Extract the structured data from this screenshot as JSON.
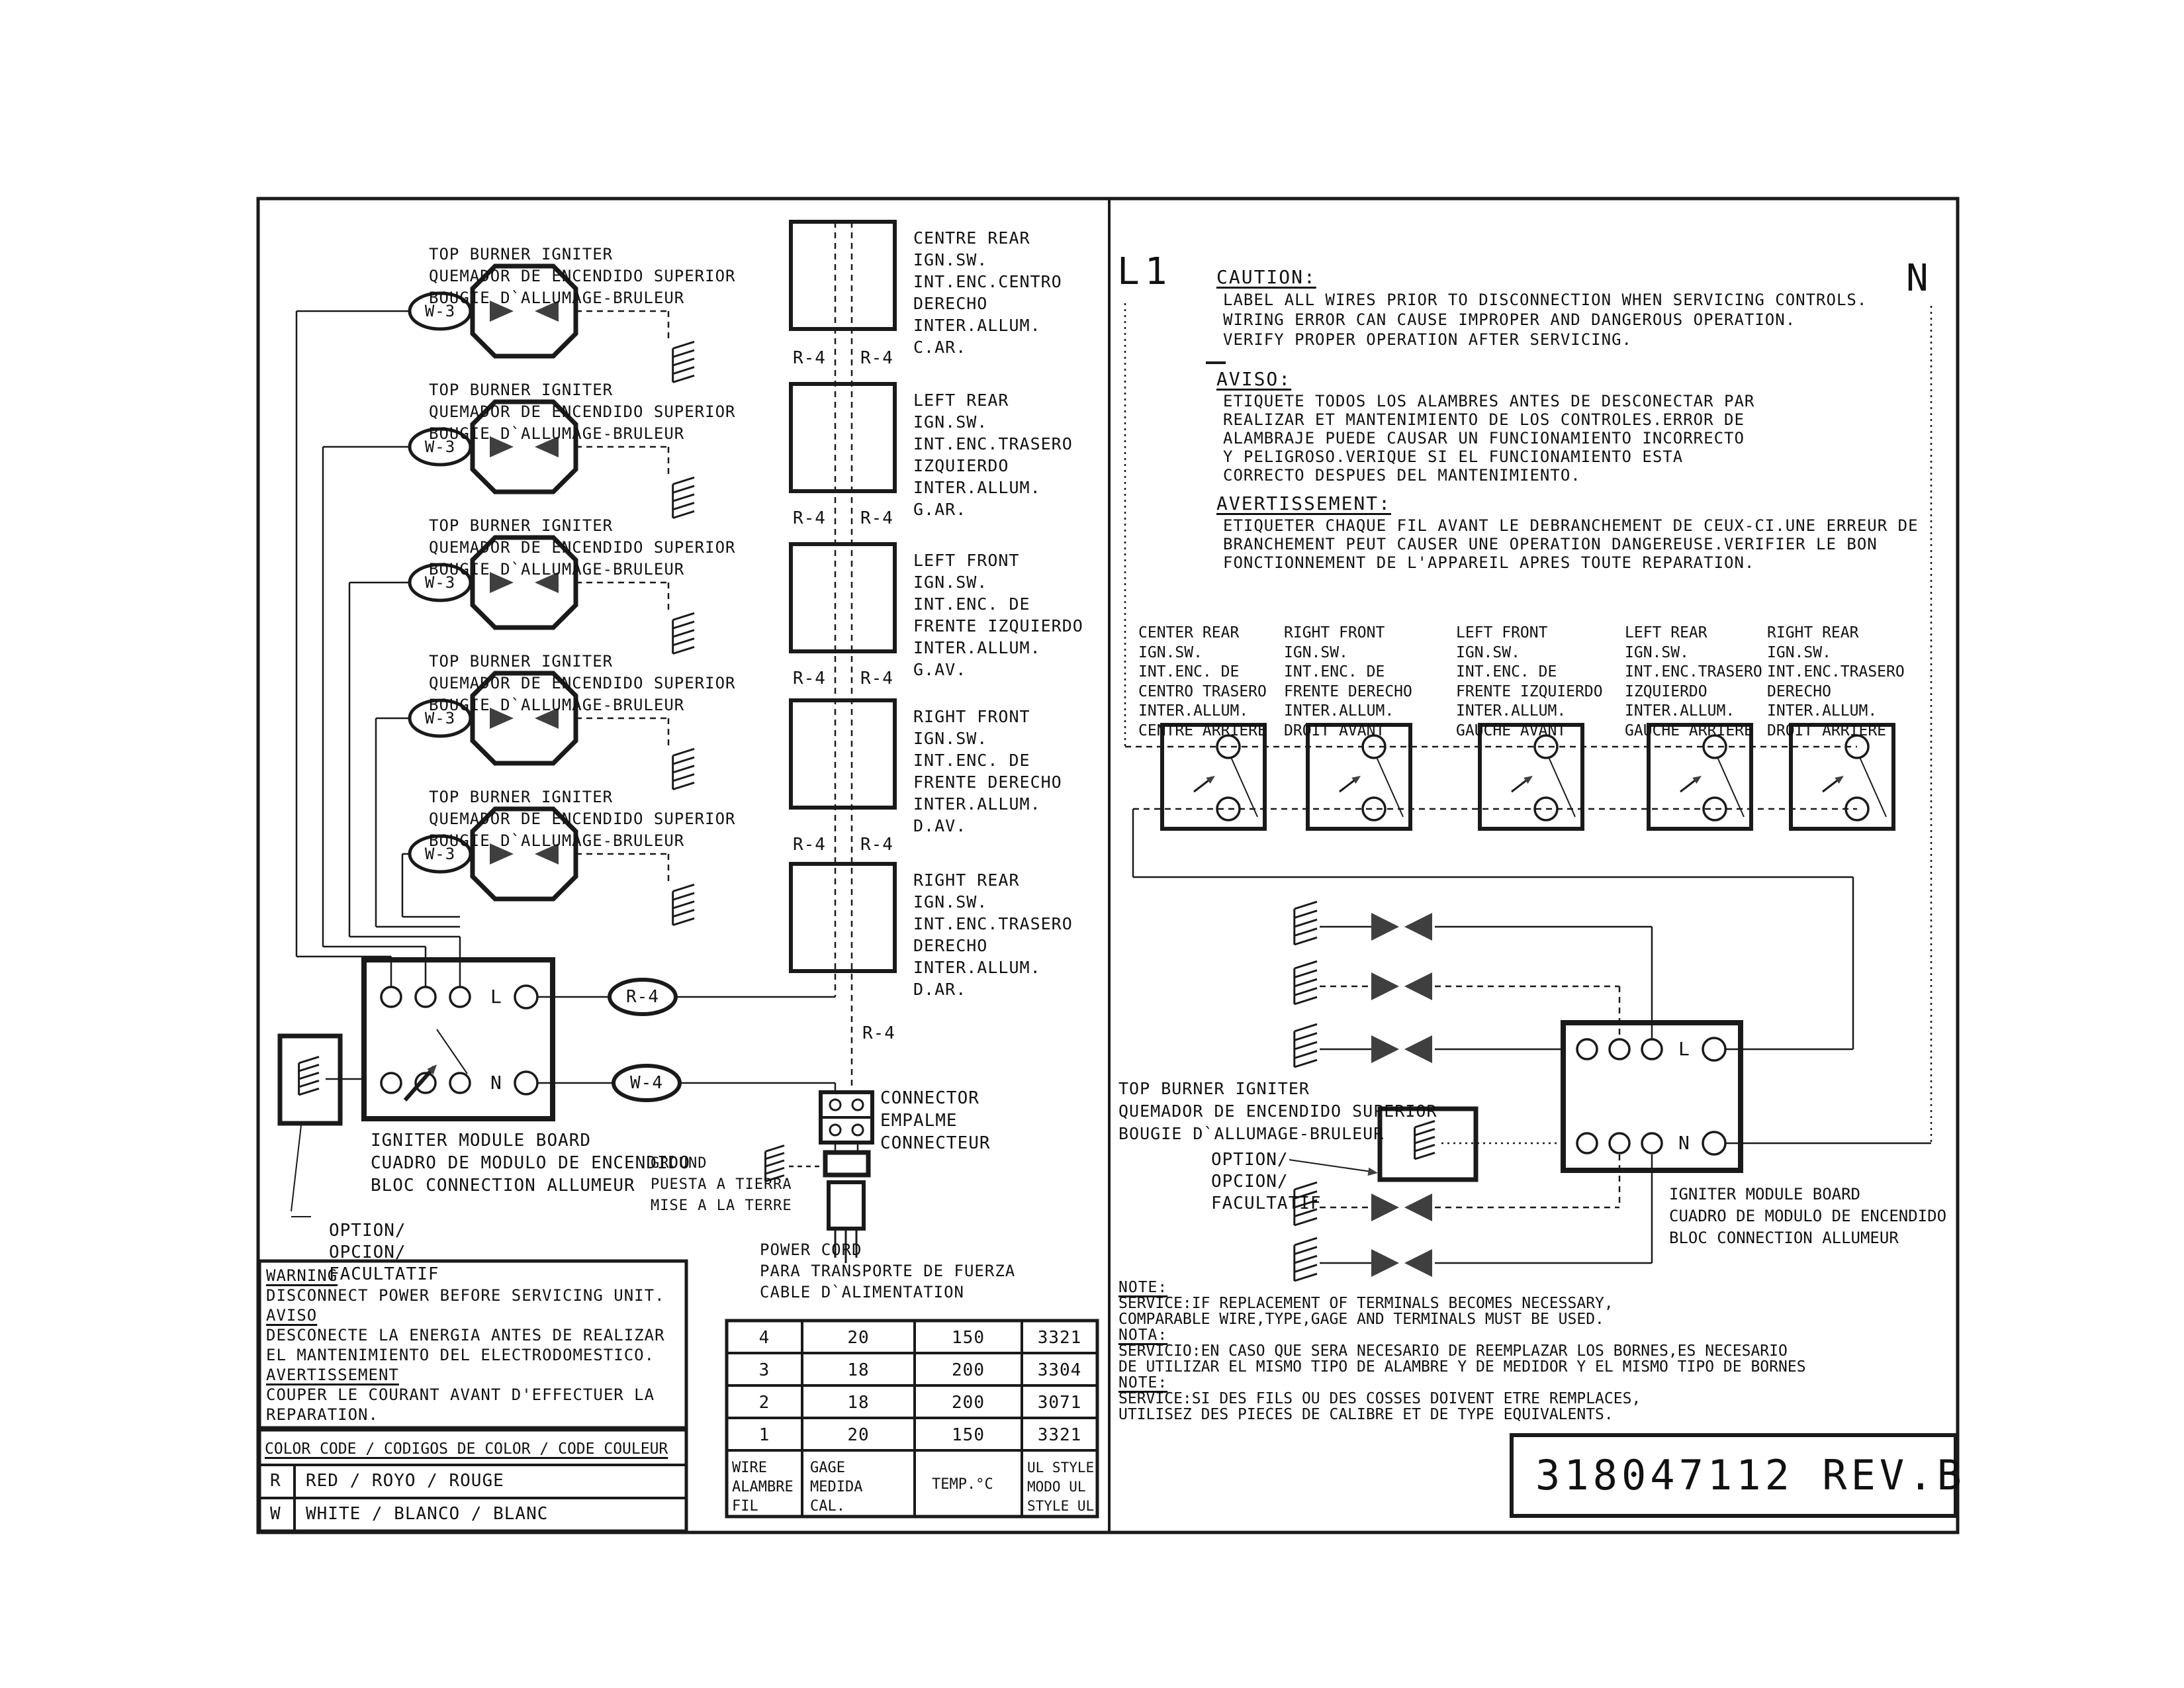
{
  "drawing": {
    "part_number": "318047112 REV.B",
    "l1": "L1",
    "n_supply": "N",
    "w3": "W-3",
    "r4": "R-4",
    "w4": "W-4",
    "terminal_l": "L",
    "terminal_n": "N"
  },
  "left": {
    "igniter_label": [
      "TOP BURNER IGNITER",
      "QUEMADOR DE ENCENDIDO SUPERIOR",
      "BOUGIE D`ALLUMAGE-BRULEUR"
    ],
    "switches": [
      {
        "lines": [
          "CENTRE REAR",
          "IGN.SW.",
          "INT.ENC.CENTRO",
          "DERECHO",
          "INTER.ALLUM.",
          "C.AR."
        ]
      },
      {
        "lines": [
          "LEFT REAR",
          "IGN.SW.",
          "INT.ENC.TRASERO",
          "IZQUIERDO",
          "INTER.ALLUM.",
          "G.AR."
        ]
      },
      {
        "lines": [
          "LEFT FRONT",
          "IGN.SW.",
          "INT.ENC. DE",
          "FRENTE IZQUIERDO",
          "INTER.ALLUM.",
          "G.AV."
        ]
      },
      {
        "lines": [
          "RIGHT FRONT",
          "IGN.SW.",
          "INT.ENC. DE",
          "FRENTE DERECHO",
          "INTER.ALLUM.",
          "D.AV."
        ]
      },
      {
        "lines": [
          "RIGHT REAR",
          "IGN.SW.",
          "INT.ENC.TRASERO",
          "DERECHO",
          "INTER.ALLUM.",
          "D.AR."
        ]
      }
    ],
    "module_board_label": [
      "IGNITER MODULE BOARD",
      "CUADRO DE MODULO DE ENCENDIDO",
      "BLOC CONNECTION ALLUMEUR"
    ],
    "option_label": [
      "OPTION/",
      "OPCION/",
      "FACULTATIF"
    ],
    "ground_label": [
      "GROUND",
      "PUESTA A TIERRA",
      "MISE A LA TERRE"
    ],
    "connector_label": [
      "CONNECTOR",
      "EMPALME",
      "CONNECTEUR"
    ],
    "power_cord_label": [
      "POWER CORD",
      "PARA TRANSPORTE DE FUERZA",
      "CABLE D`ALIMENTATION"
    ]
  },
  "right": {
    "caution": {
      "heading": "CAUTION:",
      "lines": [
        "LABEL ALL WIRES PRIOR TO DISCONNECTION WHEN SERVICING CONTROLS.",
        "WIRING ERROR CAN CAUSE IMPROPER AND DANGEROUS OPERATION.",
        "VERIFY PROPER OPERATION AFTER SERVICING."
      ]
    },
    "aviso": {
      "heading": "AVISO:",
      "lines": [
        "ETIQUETE TODOS LOS ALAMBRES ANTES DE DESCONECTAR PAR",
        "REALIZAR ET MANTENIMIENTO DE LOS CONTROLES.ERROR DE",
        "ALAMBRAJE PUEDE CAUSAR UN FUNCIONAMIENTO INCORRECTO",
        "Y PELIGROSO.VERIQUE SI EL FUNCIONAMIENTO ESTA",
        "CORRECTO DESPUES DEL MANTENIMIENTO."
      ]
    },
    "avertissement": {
      "heading": "AVERTISSEMENT:",
      "lines": [
        "ETIQUETER CHAQUE FIL AVANT LE DEBRANCHEMENT DE CEUX-CI.UNE ERREUR DE",
        "BRANCHEMENT PEUT CAUSER UNE OPERATION DANGEREUSE.VERIFIER LE BON",
        "FONCTIONNEMENT DE L'APPAREIL APRES TOUTE REPARATION."
      ]
    },
    "switches": [
      {
        "lines": [
          "CENTER REAR",
          "IGN.SW.",
          "INT.ENC. DE",
          "CENTRO TRASERO",
          "INTER.ALLUM.",
          "CENTRE ARRIERE"
        ]
      },
      {
        "lines": [
          "RIGHT FRONT",
          "IGN.SW.",
          "INT.ENC. DE",
          "FRENTE DERECHO",
          "INTER.ALLUM.",
          "DROIT AVANT"
        ]
      },
      {
        "lines": [
          "LEFT FRONT",
          "IGN.SW.",
          "INT.ENC. DE",
          "FRENTE IZQUIERDO",
          "INTER.ALLUM.",
          "GAUCHE AVANT"
        ]
      },
      {
        "lines": [
          "LEFT REAR",
          "IGN.SW.",
          "INT.ENC.TRASERO",
          "IZQUIERDO",
          "INTER.ALLUM.",
          "GAUCHE ARRIERE"
        ]
      },
      {
        "lines": [
          "RIGHT REAR",
          "IGN.SW.",
          "INT.ENC.TRASERO",
          "DERECHO",
          "INTER.ALLUM.",
          "DROIT ARRIERE"
        ]
      }
    ],
    "igniter_label": [
      "TOP BURNER IGNITER",
      "QUEMADOR DE ENCENDIDO SUPERIOR",
      "BOUGIE D`ALLUMAGE-BRULEUR"
    ],
    "option_label": [
      "OPTION/",
      "OPCION/",
      "FACULTATIF"
    ],
    "module_board_label": [
      "IGNITER MODULE BOARD",
      "CUADRO DE MODULO DE ENCENDIDO",
      "BLOC CONNECTION ALLUMEUR"
    ],
    "notes": [
      {
        "heading": "NOTE:",
        "lines": [
          "SERVICE:IF REPLACEMENT OF TERMINALS BECOMES NECESSARY,",
          "COMPARABLE WIRE,TYPE,GAGE AND TERMINALS MUST BE USED."
        ]
      },
      {
        "heading": "NOTA:",
        "lines": [
          "SERVICIO:EN CASO QUE SERA NECESARIO DE REEMPLAZAR LOS BORNES,ES NECESARIO",
          "DE UTILIZAR EL MISMO TIPO DE ALAMBRE Y DE MEDIDOR Y EL MISMO TIPO DE BORNES"
        ]
      },
      {
        "heading": "NOTE:",
        "lines": [
          "SERVICE:SI DES FILS OU DES COSSES DOIVENT ETRE REMPLACES,",
          "UTILISEZ DES PIECES DE CALIBRE ET DE TYPE EQUIVALENTS."
        ]
      }
    ]
  },
  "warning_box": {
    "sections": [
      {
        "heading": "WARNING",
        "lines": [
          "DISCONNECT POWER BEFORE SERVICING UNIT."
        ]
      },
      {
        "heading": "AVISO",
        "lines": [
          "DESCONECTE LA ENERGIA ANTES DE REALIZAR",
          "EL MANTENIMIENTO DEL ELECTRODOMESTICO."
        ]
      },
      {
        "heading": "AVERTISSEMENT",
        "lines": [
          "COUPER LE COURANT AVANT D'EFFECTUER LA",
          "REPARATION."
        ]
      }
    ]
  },
  "color_code": {
    "title": "COLOR CODE / CODIGOS DE COLOR / CODE COULEUR",
    "rows": [
      {
        "code": "R",
        "label": "RED / ROYO / ROUGE"
      },
      {
        "code": "W",
        "label": "WHITE / BLANCO / BLANC"
      }
    ]
  },
  "wire_table": {
    "rows": [
      [
        "4",
        "20",
        "150",
        "3321"
      ],
      [
        "3",
        "18",
        "200",
        "3304"
      ],
      [
        "2",
        "18",
        "200",
        "3071"
      ],
      [
        "1",
        "20",
        "150",
        "3321"
      ]
    ],
    "header": [
      [
        "WIRE",
        "ALAMBRE",
        "FIL"
      ],
      [
        "GAGE",
        "MEDIDA",
        "CAL."
      ],
      [
        "TEMP.°C"
      ],
      [
        "UL STYLE",
        "MODO UL",
        "STYLE UL"
      ]
    ]
  }
}
